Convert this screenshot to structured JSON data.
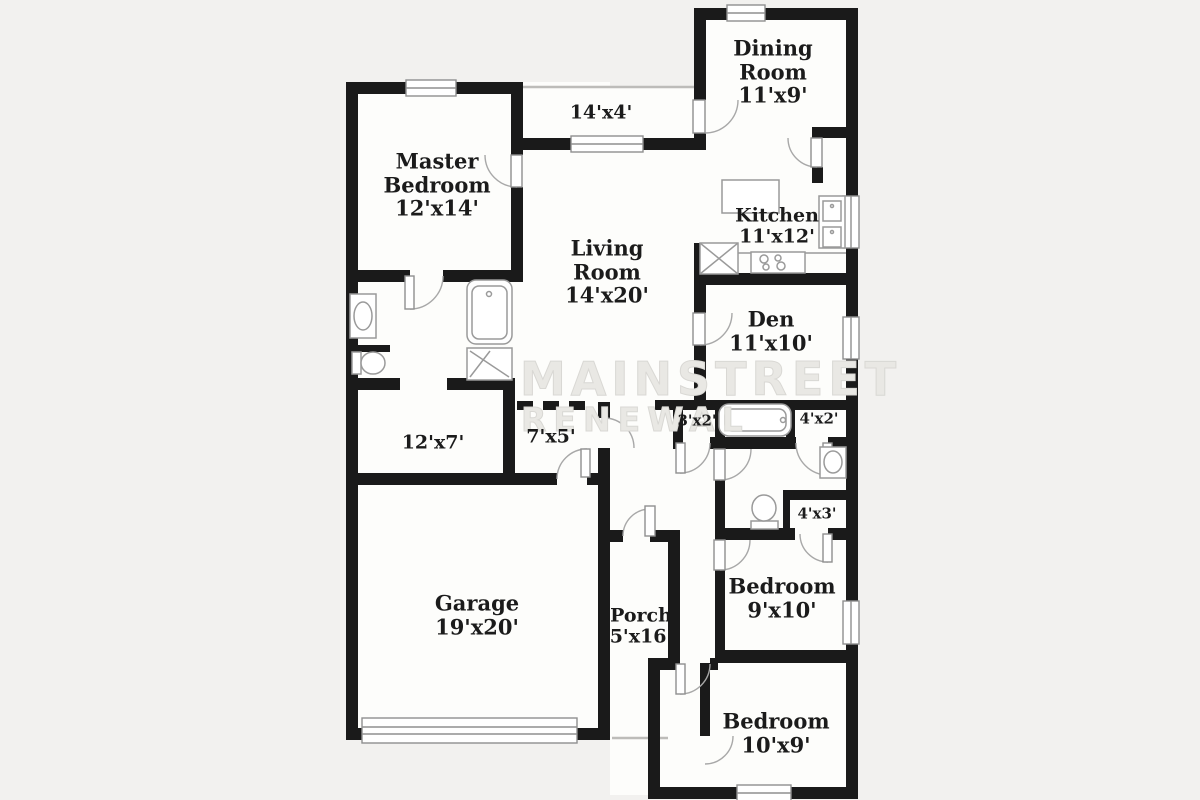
{
  "title": "Floor plan",
  "watermark": {
    "line1": "MAINSTREET",
    "line2": "RENEWAL"
  },
  "rooms": [
    {
      "id": "dining-room",
      "name": "Dining Room",
      "dims": "11'x9'"
    },
    {
      "id": "entry",
      "name": "",
      "dims": "14'x4'"
    },
    {
      "id": "master-bedroom",
      "name": "Master Bedroom",
      "dims": "12'x14'"
    },
    {
      "id": "living-room",
      "name": "Living Room",
      "dims": "14'x20'"
    },
    {
      "id": "kitchen",
      "name": "Kitchen",
      "dims": "11'x12'"
    },
    {
      "id": "den",
      "name": "Den",
      "dims": "11'x10'"
    },
    {
      "id": "closet-3x2",
      "name": "",
      "dims": "3'x2'"
    },
    {
      "id": "closet-4x2",
      "name": "",
      "dims": "4'x2'"
    },
    {
      "id": "utility-12x7",
      "name": "",
      "dims": "12'x7'"
    },
    {
      "id": "hall-7x5",
      "name": "",
      "dims": "7'x5'"
    },
    {
      "id": "closet-4x3",
      "name": "",
      "dims": "4'x3'"
    },
    {
      "id": "garage",
      "name": "Garage",
      "dims": "19'x20'"
    },
    {
      "id": "porch",
      "name": "Porch",
      "dims": "5'x16'"
    },
    {
      "id": "bedroom-2",
      "name": "Bedroom",
      "dims": "9'x10'"
    },
    {
      "id": "bedroom-3",
      "name": "Bedroom",
      "dims": "10'x9'"
    }
  ],
  "fixtures": [
    "bathtub",
    "shower",
    "toilet",
    "sink-vanity",
    "double-sink",
    "kitchen-island",
    "stove",
    "pantry",
    "garage-door"
  ],
  "colors": {
    "wall": "#1a1a1a",
    "paper": "#fdfdfb",
    "margin": "#f2f1ef",
    "fixture_stroke": "#9a9a9a",
    "window_stroke": "#8f8f8f",
    "label": "#1b1b1b",
    "watermark": "#dcdbd7"
  }
}
